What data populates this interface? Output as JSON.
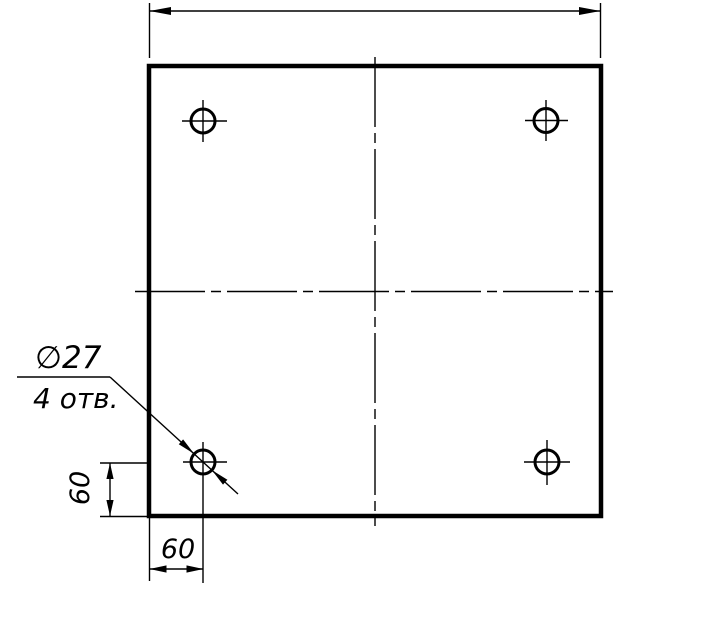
{
  "drawing": {
    "background_color": "#ffffff",
    "line_color": "#000000"
  },
  "labels": {
    "hole_diameter": "∅27",
    "hole_count": "4 отв.",
    "dim_vertical": "60",
    "dim_horizontal": "60"
  }
}
